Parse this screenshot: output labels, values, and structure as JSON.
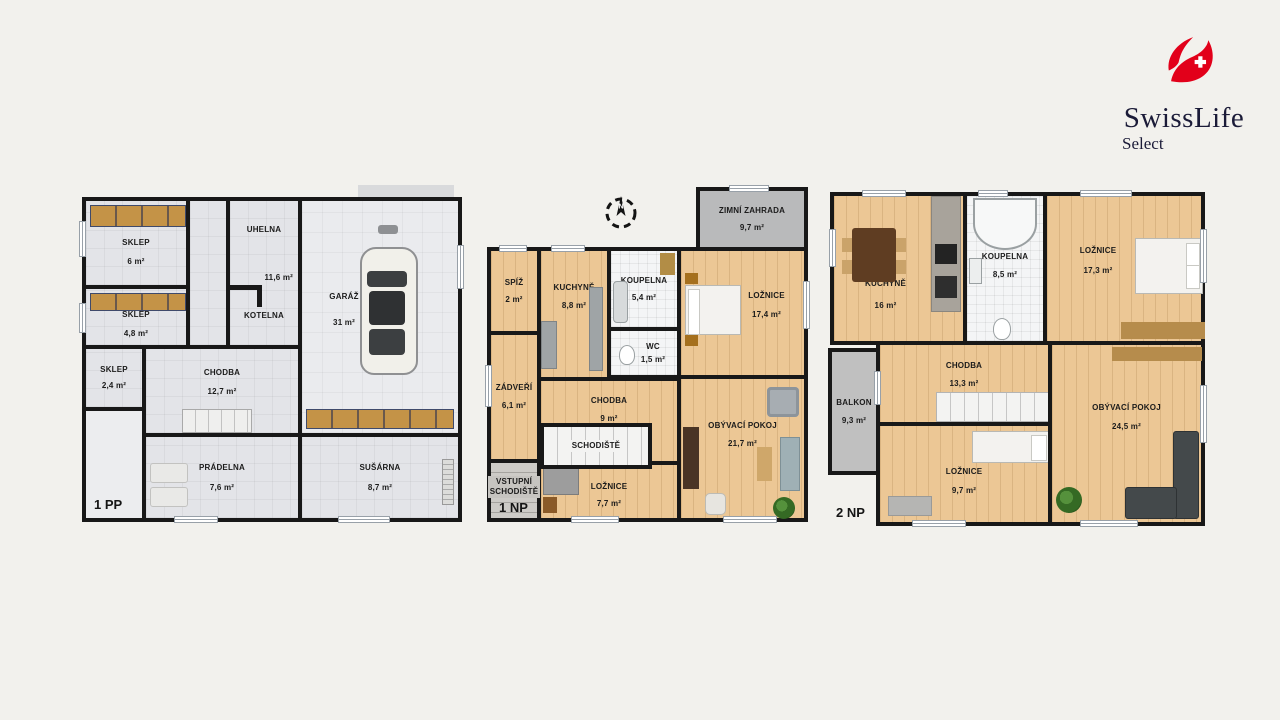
{
  "logo": {
    "brand": "SwissLife",
    "sub": "Select",
    "red": "#e2001a",
    "navy": "#1b1b38"
  },
  "compass": {
    "n": "N"
  },
  "plans": [
    {
      "floor": "1 PP",
      "rooms": {
        "sklep6": {
          "name": "SKLEP",
          "area": "6 m²"
        },
        "sklep48": {
          "name": "SKLEP",
          "area": "4,8 m²"
        },
        "sklep24": {
          "name": "SKLEP",
          "area": "2,4 m²"
        },
        "uhelna": {
          "name": "UHELNA",
          "area": "11,6 m²",
          "name2": "KOTELNA"
        },
        "garaz": {
          "name": "GARÁŽ",
          "area": "31 m²"
        },
        "chodba": {
          "name": "CHODBA",
          "area": "12,7 m²"
        },
        "pradelna": {
          "name": "PRÁDELNA",
          "area": "7,6 m²"
        },
        "susarna": {
          "name": "SUŠÁRNA",
          "area": "8,7 m²"
        }
      }
    },
    {
      "floor": "1 NP",
      "rooms": {
        "zimni": {
          "name": "ZIMNÍ ZAHRADA",
          "area": "9,7 m²"
        },
        "spiz": {
          "name": "SPÍŽ",
          "area": "2 m²"
        },
        "kuchyne": {
          "name": "KUCHYNĚ",
          "area": "8,8 m²"
        },
        "koupelna": {
          "name": "KOUPELNA",
          "area": "5,4 m²"
        },
        "wc": {
          "name": "WC",
          "area": "1,5 m²"
        },
        "loznice17": {
          "name": "LOŽNICE",
          "area": "17,4 m²"
        },
        "zadveri": {
          "name": "ZÁDVEŘÍ",
          "area": "6,1 m²"
        },
        "chodba": {
          "name": "CHODBA",
          "area": "9 m²"
        },
        "schodiste": {
          "name": "SCHODIŠTĚ"
        },
        "vstupni": {
          "name": "VSTUPNÍ SCHODIŠTĚ"
        },
        "loznice77": {
          "name": "LOŽNICE",
          "area": "7,7 m²"
        },
        "obyvaci": {
          "name": "OBÝVACÍ POKOJ",
          "area": "21,7 m²"
        }
      }
    },
    {
      "floor": "2 NP",
      "rooms": {
        "kuchyne": {
          "name": "KUCHYNĚ",
          "area": "16 m²"
        },
        "koupelna": {
          "name": "KOUPELNA",
          "area": "8,5 m²"
        },
        "loznice17": {
          "name": "LOŽNICE",
          "area": "17,3 m²"
        },
        "balkon": {
          "name": "BALKON",
          "area": "9,3 m²"
        },
        "chodba": {
          "name": "CHODBA",
          "area": "13,3 m²"
        },
        "loznice97": {
          "name": "LOŽNICE",
          "area": "9,7 m²"
        },
        "obyvaci": {
          "name": "OBÝVACÍ POKOJ",
          "area": "24,5 m²"
        }
      }
    }
  ]
}
